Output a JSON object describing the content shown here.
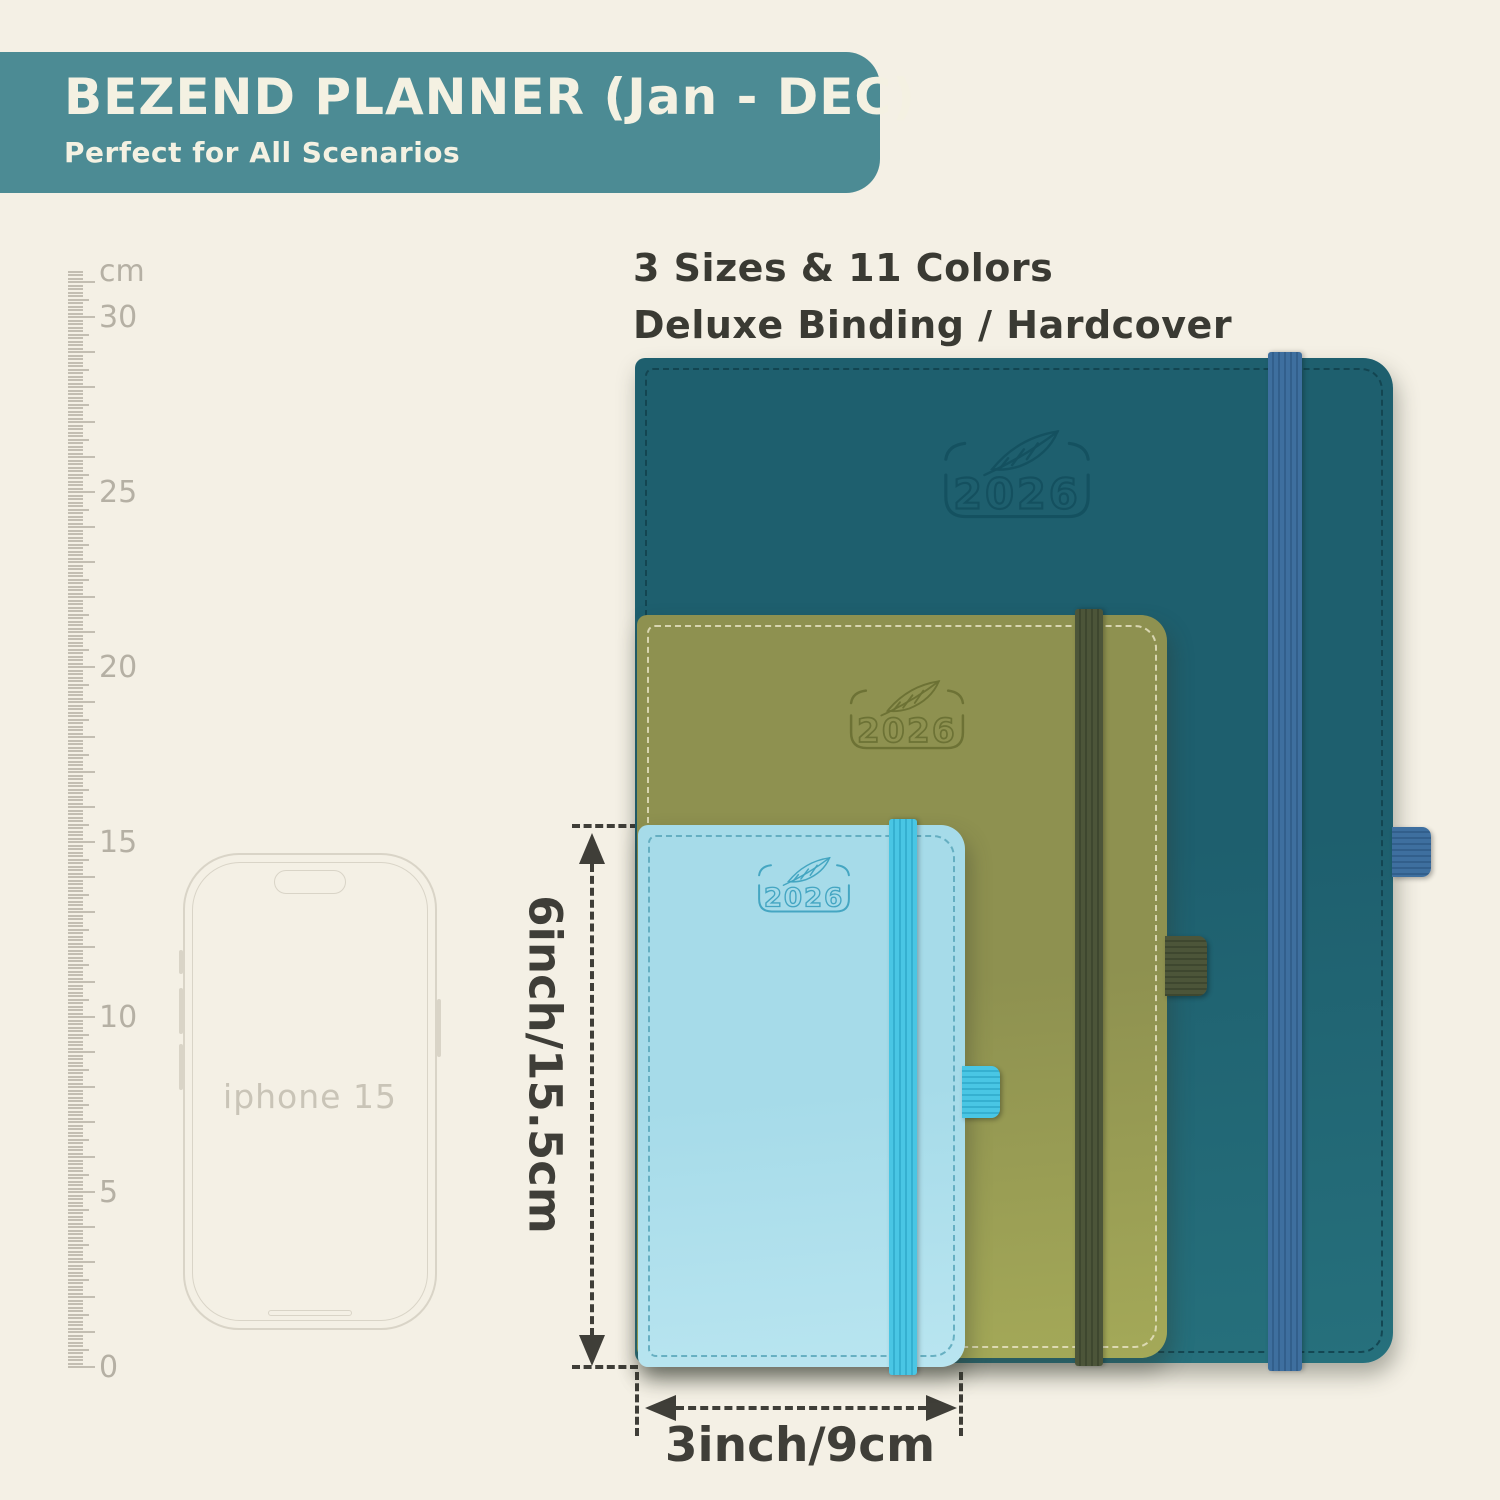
{
  "banner": {
    "title": "BEZEND PLANNER (Jan - DEC)",
    "subtitle": "Perfect for All Scenarios"
  },
  "features": {
    "line1": "3 Sizes & 11 Colors",
    "line2": "Deluxe Binding / Hardcover"
  },
  "ruler": {
    "unit_label": "cm",
    "labeled_marks": [
      30,
      25,
      20,
      15,
      10,
      5,
      0
    ],
    "px_per_cm": 35,
    "zero_y": 1367,
    "total_mm": 313
  },
  "phone": {
    "label": "iphone 15"
  },
  "planners": [
    {
      "id": "large",
      "size_name": "large-teal",
      "year": "2026",
      "body": "#1e5f6e",
      "body_light": "#26707c",
      "logo": "#14505f",
      "stitch": "#12414d",
      "band": "#3e6f9f",
      "band_dark": "#325f8c"
    },
    {
      "id": "medium",
      "size_name": "medium-olive",
      "year": "2026",
      "body": "#8e9150",
      "body_light": "#a4a958",
      "logo": "#6b7134",
      "stitch": "#e6e2c2",
      "band": "#4c5539",
      "band_dark": "#3e472f"
    },
    {
      "id": "small",
      "size_name": "small-blue",
      "year": "2026",
      "body": "#a6dbe9",
      "body_light": "#b9e5f0",
      "logo": "#3fa3c0",
      "stitch": "#5aa7bb",
      "band": "#49c6e4",
      "band_dark": "#35b0d0"
    }
  ],
  "dimensions": {
    "height_label": "6inch/15.5cm",
    "width_label": "3inch/9cm"
  },
  "colors": {
    "page_bg": "#f4f0e5",
    "banner_bg": "#4c8b94",
    "banner_text": "#f4f1e2",
    "text_dark": "#3a3a33",
    "ruler": "#c3beb2",
    "ruler_text": "#b5b0a4",
    "phone_line": "#d9d4c7",
    "phone_text": "#c9c4b7",
    "dim": "#3f3e38"
  }
}
